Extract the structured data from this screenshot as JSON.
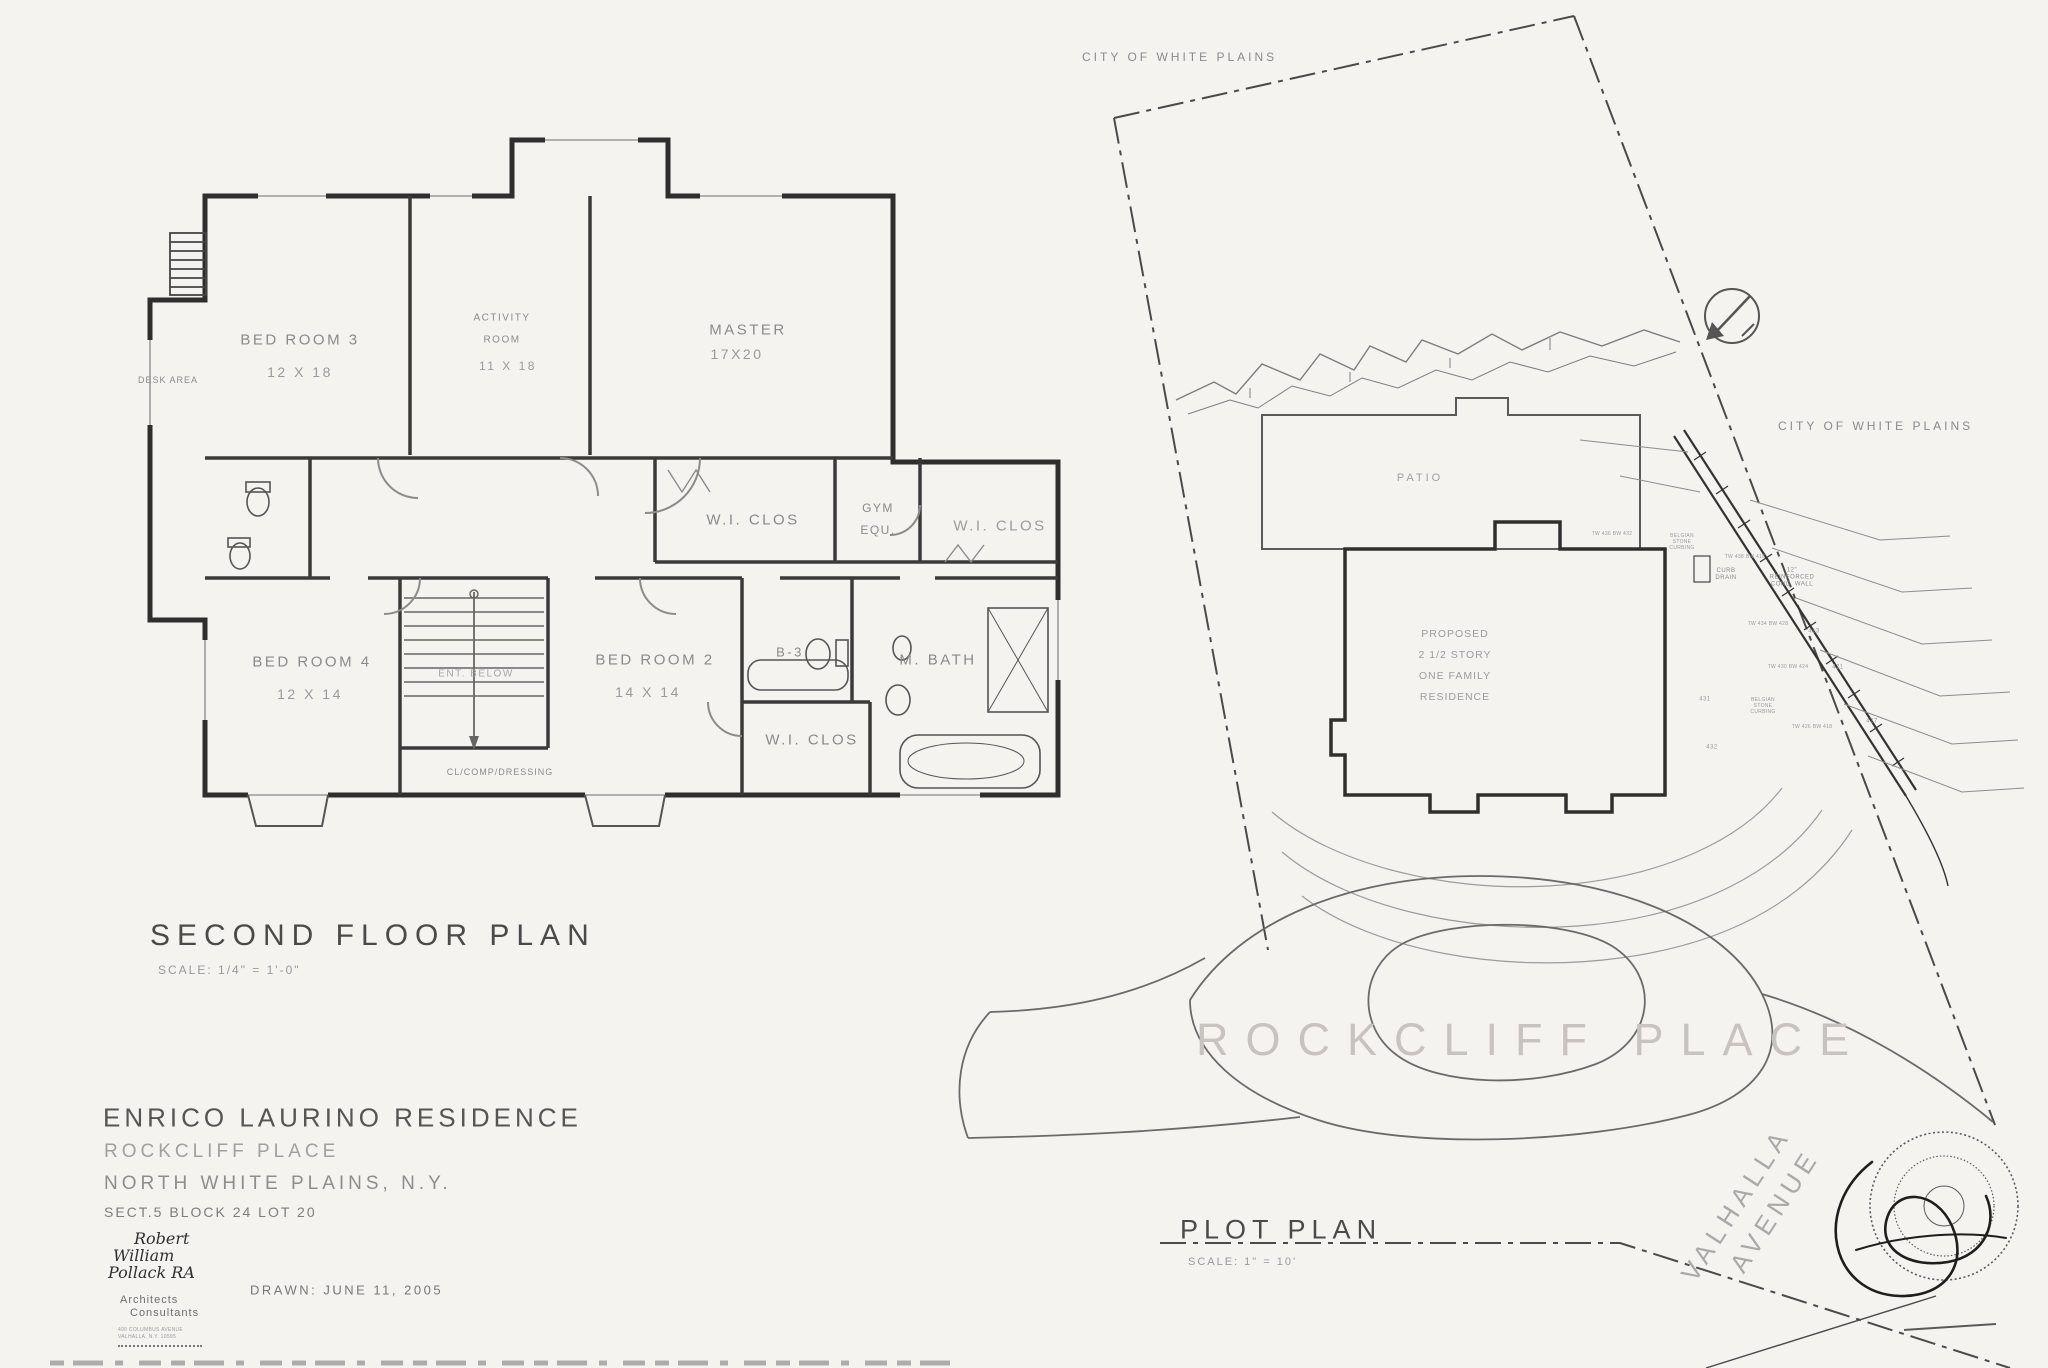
{
  "palette": {
    "paper": "#f4f3f0",
    "ink": "#2e2e2e",
    "faint": "#8a8a8a",
    "ghost": "#c7c4bf"
  },
  "floor_plan": {
    "title": "SECOND FLOOR PLAN",
    "scale_note": "SCALE: 1/4\" = 1'-0\"",
    "rooms": {
      "bed3": {
        "name": "BED ROOM 3",
        "dims": "12 X 18"
      },
      "activity": {
        "line1": "ACTIVITY",
        "line2": "ROOM",
        "dims": "11 X 18"
      },
      "master": {
        "name": "MASTER",
        "dims": "17X20"
      },
      "bed4": {
        "name": "BED ROOM 4",
        "dims": "12 X 14"
      },
      "bed2": {
        "name": "BED ROOM 2",
        "dims": "14 X 14"
      }
    },
    "labels": {
      "desk_area": "DESK AREA",
      "wic_upper_left": "W.I. CLOS",
      "gym_line1": "GYM",
      "gym_line2": "EQU.",
      "wic_upper_right": "W.I. CLOS",
      "ent_below": "ENT. BELOW",
      "bath3": "B-3",
      "master_bath": "M. BATH",
      "wic_lower": "W.I. CLOS",
      "dressing": "CL/COMP/DRESSING"
    }
  },
  "plot_plan": {
    "title": "PLOT PLAN",
    "scale_note": "SCALE: 1\" = 10'",
    "city_top": "CITY OF WHITE PLAINS",
    "city_right": "CITY OF WHITE PLAINS",
    "patio": "PATIO",
    "residence": {
      "l1": "PROPOSED",
      "l2": "2 1/2 STORY",
      "l3": "ONE FAMILY",
      "l4": "RESIDENCE"
    },
    "street": "ROCKCLIFF  PLACE",
    "avenue_line1": "VALHALLA",
    "avenue_line2": "AVENUE",
    "notes": {
      "curb_drain_l1": "CURB",
      "curb_drain_l2": "DRAIN",
      "wall_l1": "12\"",
      "wall_l2": "REINFORCED",
      "wall_l3": "CONC. WALL",
      "curbing_l1": "BELGIAN",
      "curbing_l2": "STONE",
      "curbing_l3": "CURBING",
      "tw1": "TW 438 BW 416",
      "tw2": "TW 434 BW 428",
      "tw3": "TW 430 BW 424",
      "tw4": "TW 426 BW 418",
      "tw5": "TW 436 BW 432"
    },
    "contours": {
      "c431": "431",
      "c432": "432",
      "c427": "427",
      "c421": "421",
      "c413": "413"
    }
  },
  "title_block": {
    "project": "ENRICO LAURINO RESIDENCE",
    "street": "ROCKCLIFF PLACE",
    "city": "NORTH WHITE PLAINS, N.Y.",
    "lot": "SECT.5 BLOCK 24 LOT 20",
    "drawn": "DRAWN: JUNE 11, 2005",
    "architect": {
      "n1": "Robert",
      "n2": "William",
      "n3": "Pollack RA",
      "r1": "Architects",
      "r2": "Consultants",
      "a1": "400 COLUMBUS AVENUE",
      "a2": "VALHALLA, N.Y. 10595"
    }
  }
}
